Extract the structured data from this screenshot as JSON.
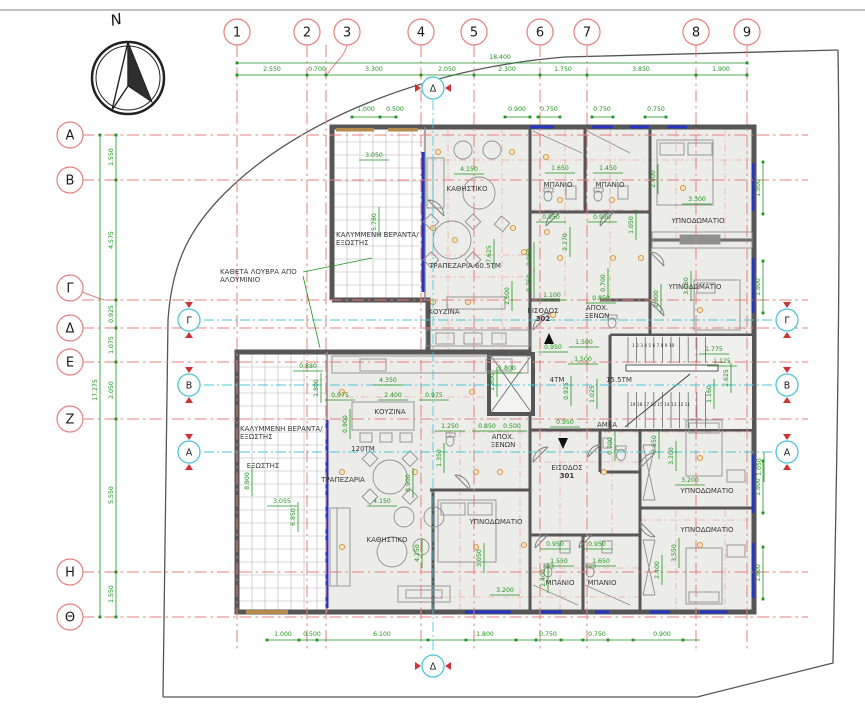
{
  "compass": {
    "north_label": "N"
  },
  "grid": {
    "columns": [
      {
        "label": "1",
        "x": 237
      },
      {
        "label": "2",
        "x": 307
      },
      {
        "label": "3",
        "x": 326,
        "bx": 347
      },
      {
        "label": "4",
        "x": 421
      },
      {
        "label": "5",
        "x": 474
      },
      {
        "label": "6",
        "x": 540
      },
      {
        "label": "7",
        "x": 587
      },
      {
        "label": "8",
        "x": 696
      },
      {
        "label": "9",
        "x": 747
      }
    ],
    "rows": [
      {
        "label": "Α",
        "y": 135
      },
      {
        "label": "Β",
        "y": 180
      },
      {
        "label": "Γ",
        "y": 300,
        "by": 288
      },
      {
        "label": "Δ",
        "y": 328
      },
      {
        "label": "Ε",
        "y": 362
      },
      {
        "label": "Ζ",
        "y": 419
      },
      {
        "label": "Η",
        "y": 572
      },
      {
        "label": "Θ",
        "y": 617
      }
    ]
  },
  "section_markers": {
    "vertical_label": "Δ",
    "side": [
      {
        "label": "Γ",
        "y": 320
      },
      {
        "label": "Β",
        "y": 385
      },
      {
        "label": "Α",
        "y": 452
      }
    ]
  },
  "dimensions": {
    "top_overall": "18.400",
    "left_overall": "17.275",
    "top": [
      {
        "t": "2.550",
        "x": 272
      },
      {
        "t": "0.700",
        "x": 317
      },
      {
        "t": "3.300",
        "x": 374
      },
      {
        "t": "2.050",
        "x": 447
      },
      {
        "t": "2.300",
        "x": 507
      },
      {
        "t": "1.750",
        "x": 563
      },
      {
        "t": "3.850",
        "x": 641
      },
      {
        "t": "1.900",
        "x": 721
      }
    ],
    "top_small": [
      {
        "t": "1.000",
        "x": 366
      },
      {
        "t": "0.500",
        "x": 395
      },
      {
        "t": "0.900",
        "x": 517
      },
      {
        "t": "0.750",
        "x": 549
      },
      {
        "t": "0.750",
        "x": 602
      },
      {
        "t": "0.750",
        "x": 656
      }
    ],
    "left": [
      {
        "t": "1.550",
        "y": 157
      },
      {
        "t": "4.575",
        "y": 240
      },
      {
        "t": "0.925",
        "y": 314
      },
      {
        "t": "1.075",
        "y": 345
      },
      {
        "t": "2.050",
        "y": 390
      },
      {
        "t": "5.550",
        "y": 495
      },
      {
        "t": "1.550",
        "y": 594
      }
    ],
    "bottom": [
      {
        "t": "1.000",
        "x": 283
      },
      {
        "t": "0.500",
        "x": 312
      },
      {
        "t": "6.100",
        "x": 382
      },
      {
        "t": "1.800",
        "x": 485
      },
      {
        "t": "0.750",
        "x": 548
      },
      {
        "t": "0.750",
        "x": 597
      },
      {
        "t": "0.900",
        "x": 662
      }
    ],
    "right": [
      {
        "t": "1.800",
        "y": 188
      },
      {
        "t": "1.800",
        "y": 287
      },
      {
        "t": "1.800",
        "y": 487
      },
      {
        "t": "1.800",
        "y": 573
      }
    ],
    "interior": [
      {
        "t": "3.050",
        "x": 374,
        "y": 157
      },
      {
        "t": "5.780",
        "x": 376,
        "y": 222,
        "v": 1
      },
      {
        "t": "4.150",
        "x": 469,
        "y": 171
      },
      {
        "t": "7.625",
        "x": 491,
        "y": 254,
        "v": 1
      },
      {
        "t": "0.850",
        "x": 531,
        "y": 257,
        "v": 1
      },
      {
        "t": "0.750",
        "x": 531,
        "y": 283,
        "v": 1
      },
      {
        "t": "2.600",
        "x": 509,
        "y": 296,
        "v": 1
      },
      {
        "t": "1.650",
        "x": 560,
        "y": 170
      },
      {
        "t": "1.450",
        "x": 608,
        "y": 170
      },
      {
        "t": "0.950",
        "x": 551,
        "y": 219
      },
      {
        "t": "0.950",
        "x": 602,
        "y": 219
      },
      {
        "t": "2.270",
        "x": 567,
        "y": 242,
        "v": 1
      },
      {
        "t": "1.050",
        "x": 633,
        "y": 225,
        "v": 1
      },
      {
        "t": "2.400",
        "x": 655,
        "y": 179,
        "v": 1
      },
      {
        "t": "3.300",
        "x": 697,
        "y": 201
      },
      {
        "t": "3.150",
        "x": 688,
        "y": 286,
        "v": 1
      },
      {
        "t": "2.000",
        "x": 658,
        "y": 299,
        "v": 1
      },
      {
        "t": "1.100",
        "x": 552,
        "y": 297
      },
      {
        "t": "0.850",
        "x": 601,
        "y": 300
      },
      {
        "t": "0.700",
        "x": 605,
        "y": 283,
        "v": 1
      },
      {
        "t": "1.800",
        "x": 507,
        "y": 370
      },
      {
        "t": "1.800",
        "x": 494,
        "y": 382,
        "v": 1
      },
      {
        "t": "0.950",
        "x": 553,
        "y": 349
      },
      {
        "t": "1.500",
        "x": 584,
        "y": 344
      },
      {
        "t": "1.500",
        "x": 583,
        "y": 361
      },
      {
        "t": "0.925",
        "x": 568,
        "y": 391,
        "v": 1
      },
      {
        "t": "1.025",
        "x": 594,
        "y": 394,
        "v": 1
      },
      {
        "t": "0.950",
        "x": 565,
        "y": 424
      },
      {
        "t": "1.775",
        "x": 714,
        "y": 351
      },
      {
        "t": "1.125",
        "x": 722,
        "y": 363
      },
      {
        "t": "2.625",
        "x": 728,
        "y": 378,
        "v": 1
      },
      {
        "t": "1.160",
        "x": 711,
        "y": 394,
        "v": 1
      },
      {
        "t": "0.880",
        "x": 308,
        "y": 368
      },
      {
        "t": "1.800",
        "x": 318,
        "y": 388,
        "v": 1
      },
      {
        "t": "4.350",
        "x": 388,
        "y": 382
      },
      {
        "t": "0.975",
        "x": 340,
        "y": 397
      },
      {
        "t": "2.400",
        "x": 393,
        "y": 397
      },
      {
        "t": "0.975",
        "x": 434,
        "y": 397
      },
      {
        "t": "0.900",
        "x": 347,
        "y": 424,
        "v": 1
      },
      {
        "t": "8.900",
        "x": 249,
        "y": 481,
        "v": 1
      },
      {
        "t": "8.900",
        "x": 410,
        "y": 483,
        "v": 1
      },
      {
        "t": "3.055",
        "x": 282,
        "y": 503
      },
      {
        "t": "6.850",
        "x": 295,
        "y": 517,
        "v": 1
      },
      {
        "t": "4.150",
        "x": 382,
        "y": 503
      },
      {
        "t": "4.250",
        "x": 419,
        "y": 553,
        "v": 1
      },
      {
        "t": "1.250",
        "x": 450,
        "y": 428
      },
      {
        "t": "0.850",
        "x": 487,
        "y": 428
      },
      {
        "t": "0.500",
        "x": 512,
        "y": 428
      },
      {
        "t": "1.350",
        "x": 441,
        "y": 458,
        "v": 1
      },
      {
        "t": "3.050",
        "x": 481,
        "y": 558,
        "v": 1
      },
      {
        "t": "3.200",
        "x": 505,
        "y": 592
      },
      {
        "t": "0.950",
        "x": 555,
        "y": 546
      },
      {
        "t": "0.950",
        "x": 597,
        "y": 546
      },
      {
        "t": "1.550",
        "x": 559,
        "y": 563
      },
      {
        "t": "1.650",
        "x": 601,
        "y": 563
      },
      {
        "t": "2.400",
        "x": 545,
        "y": 578,
        "v": 1
      },
      {
        "t": "2.400",
        "x": 659,
        "y": 570,
        "v": 1
      },
      {
        "t": "2.650",
        "x": 656,
        "y": 444,
        "v": 1
      },
      {
        "t": "3.200",
        "x": 673,
        "y": 456,
        "v": 1
      },
      {
        "t": "3.200",
        "x": 690,
        "y": 482
      },
      {
        "t": "3.550",
        "x": 676,
        "y": 553,
        "v": 1
      },
      {
        "t": "1.050",
        "x": 761,
        "y": 467,
        "v": 1
      },
      {
        "t": "0.700",
        "x": 612,
        "y": 446,
        "v": 1
      }
    ]
  },
  "rooms": [
    {
      "t": "ΚΑΛΥΜΜΕΝΗ ΒΕΡΑΝΤΑ/",
      "x": 336,
      "y": 237,
      "a": "s"
    },
    {
      "t": "ΕΞΩΣΤΗΣ",
      "x": 336,
      "y": 245,
      "a": "s"
    },
    {
      "t": "ΚΑΘΗΣΤΙΚΟ",
      "x": 467,
      "y": 191
    },
    {
      "t": "ΤΡΑΠΕΖΑΡΙΑ 60.5ΤΜ",
      "x": 465,
      "y": 268
    },
    {
      "t": "ΚΟΥΖΙΝΑ",
      "x": 444,
      "y": 314
    },
    {
      "t": "ΜΠΑΝΙΟ",
      "x": 558,
      "y": 187
    },
    {
      "t": "ΜΠΑΝΙΟ",
      "x": 610,
      "y": 187
    },
    {
      "t": "ΥΠΝΟΔΩΜΑΤΙΟ",
      "x": 698,
      "y": 223
    },
    {
      "t": "ΥΠΝΟΔΩΜΑΤΙΟ",
      "x": 695,
      "y": 289
    },
    {
      "t": "ΕΙΣΟΔΟΣ",
      "x": 543,
      "y": 313
    },
    {
      "t": "302",
      "x": 543,
      "y": 321,
      "b": 1
    },
    {
      "t": "ΑΠΟΧ.",
      "x": 597,
      "y": 310
    },
    {
      "t": "ΞΕΝΩΝ",
      "x": 597,
      "y": 318
    },
    {
      "t": "4ΤΜ",
      "x": 557,
      "y": 382
    },
    {
      "t": "15.5ΤΜ",
      "x": 619,
      "y": 382
    },
    {
      "t": "ΑΜΕΑ",
      "x": 607,
      "y": 427
    },
    {
      "t": "ΕΙΣΟΔΟΣ",
      "x": 567,
      "y": 470
    },
    {
      "t": "301",
      "x": 567,
      "y": 478,
      "b": 1
    },
    {
      "t": "ΑΠΟΧ.",
      "x": 503,
      "y": 439
    },
    {
      "t": "ΞΕΝΩΝ",
      "x": 503,
      "y": 447
    },
    {
      "t": "ΚΑΛΥΜΜΕΝΗ ΒΕΡΑΝΤΑ/",
      "x": 240,
      "y": 431,
      "a": "s"
    },
    {
      "t": "ΕΞΩΣΤΗΣ",
      "x": 240,
      "y": 439,
      "a": "s"
    },
    {
      "t": "ΕΞΩΣΤΗΣ",
      "x": 263,
      "y": 468
    },
    {
      "t": "ΚΟΥΖΙΝΑ",
      "x": 390,
      "y": 414
    },
    {
      "t": "120ΤΜ",
      "x": 363,
      "y": 451
    },
    {
      "t": "ΤΡΑΠΕΖΑΡΙΑ",
      "x": 343,
      "y": 482
    },
    {
      "t": "ΚΑΘΗΣΤΙΚΟ",
      "x": 387,
      "y": 542
    },
    {
      "t": "ΥΠΝΟΔΩΜΑΤΙΟ",
      "x": 496,
      "y": 524
    },
    {
      "t": "ΜΠΑΝΙΟ",
      "x": 560,
      "y": 585
    },
    {
      "t": "ΜΠΑΝΙΟ",
      "x": 602,
      "y": 585
    },
    {
      "t": "ΥΠΝΟΔΩΜΑΤΙΟ",
      "x": 707,
      "y": 493
    },
    {
      "t": "ΥΠΝΟΔΩΜΑΤΙΟ",
      "x": 707,
      "y": 532
    }
  ],
  "annotations": {
    "louvre_line1": "ΚΑΘΕΤΑ ΛΟΥΒΡΑ ΑΠΟ",
    "louvre_line2": "ΑΛΟΥΜΙΝΙΟ"
  },
  "stairs": {
    "flight_up": "1 2 3 4 5 6 7 8 9 10",
    "flight_down": "19 18 17 16 15 14 13 12 11"
  },
  "colors": {
    "grid_red": "#e57f7f",
    "dim_green": "#1e951e",
    "section_cyan": "#4cc4d9",
    "window_blue": "#2636c0",
    "wall_gray": "#565656",
    "floor_fill": "#ecede8",
    "lintel_tan": "#b78b4e"
  }
}
